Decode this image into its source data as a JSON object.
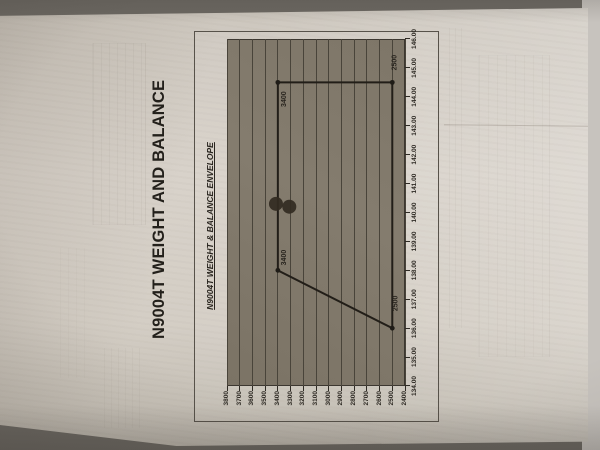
{
  "photo": {
    "paper_color": "#d6d0c7",
    "background_color": "#6b6761",
    "plot_fill": "#7f7769",
    "grid_color": "#49443a",
    "envelope_line_color": "#221e18",
    "ink_mark_color": "#332b21"
  },
  "page": {
    "main_title": "N9004T WEIGHT AND BALANCE"
  },
  "chart": {
    "title": "N9004T WEIGHT & BALANCE ENVELOPE",
    "x_axis": {
      "tick_labels": [
        "134.00",
        "135.00",
        "136.00",
        "137.00",
        "138.00",
        "139.00",
        "140.00",
        "141.00",
        "142.00",
        "143.00",
        "144.00",
        "145.00",
        "146.00"
      ]
    },
    "y_axis": {
      "tick_labels": [
        "3800",
        "3700",
        "3600",
        "3500",
        "3400",
        "3300",
        "3200",
        "3100",
        "3000",
        "2900",
        "2800",
        "2700",
        "2600",
        "2500",
        "2400"
      ]
    }
  },
  "chart_data": {
    "type": "line",
    "title": "N9004T WEIGHT & BALANCE ENVELOPE",
    "xlabel": "",
    "ylabel": "",
    "xlim": [
      134,
      146
    ],
    "ylim": [
      2400,
      3800
    ],
    "x_tick_values": [
      134,
      135,
      136,
      137,
      138,
      139,
      140,
      141,
      142,
      143,
      144,
      145,
      146
    ],
    "y_tick_values": [
      3800,
      3700,
      3600,
      3500,
      3400,
      3300,
      3200,
      3100,
      3000,
      2900,
      2800,
      2700,
      2600,
      2500,
      2400
    ],
    "grid": "horizontal",
    "legend": "none",
    "envelope_points": [
      [
        138.0,
        3400
      ],
      [
        144.5,
        3400
      ],
      [
        144.5,
        2500
      ],
      [
        136.0,
        2500
      ]
    ],
    "envelope_closed": true,
    "corner_labels": [
      {
        "text": "3400",
        "cg": 138.0,
        "weight": 3400,
        "dx": 5,
        "dy": 8,
        "anchor": "start"
      },
      {
        "text": "3400",
        "cg": 144.5,
        "weight": 3400,
        "dx": -9,
        "dy": 8,
        "anchor": "end"
      },
      {
        "text": "2500",
        "cg": 144.5,
        "weight": 2500,
        "dx": 12,
        "dy": 4,
        "anchor": "start"
      },
      {
        "text": "2500",
        "cg": 136.0,
        "weight": 2500,
        "dx": 17,
        "dy": 5,
        "anchor": "start"
      }
    ],
    "pen_marks": [
      {
        "cg": 140.3,
        "weight": 3415,
        "r": 7
      },
      {
        "cg": 140.2,
        "weight": 3310,
        "r": 7
      }
    ]
  }
}
